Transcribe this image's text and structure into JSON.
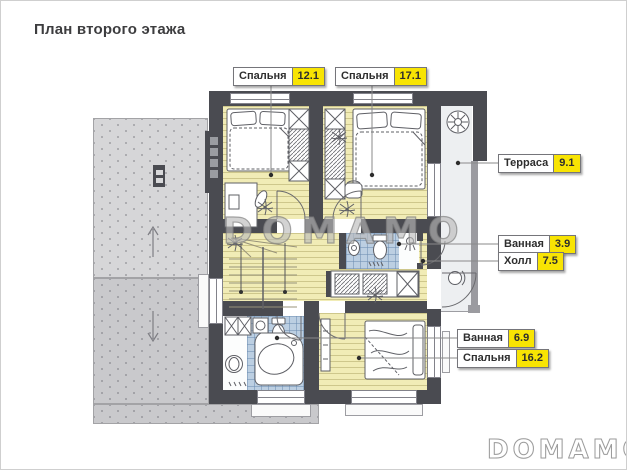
{
  "title": "План второго этажа",
  "watermark_text": "DOMAMO",
  "brand_logo": "DOMAMO",
  "colors": {
    "wall": "#4a4b51",
    "floor_wood": "#f1ecb6",
    "floor_tile": "#bccfe2",
    "roof_light": "#d6d6d8",
    "roof_dark": "#c9c9cc",
    "terrace_floor": "#edeff1",
    "label_highlight": "#f8e403",
    "label_border": "#75757a",
    "title_color": "#3d3d3f"
  },
  "rooms": [
    {
      "id": "bedroom-121",
      "name": "Спальня",
      "area": "12.1"
    },
    {
      "id": "bedroom-171",
      "name": "Спальня",
      "area": "17.1"
    },
    {
      "id": "terrace",
      "name": "Терраса",
      "area": "9.1"
    },
    {
      "id": "bathroom-39",
      "name": "Ванная",
      "area": "3.9"
    },
    {
      "id": "hall",
      "name": "Холл",
      "area": "7.5"
    },
    {
      "id": "bathroom-69",
      "name": "Ванная",
      "area": "6.9"
    },
    {
      "id": "bedroom-162",
      "name": "Спальня",
      "area": "16.2"
    }
  ]
}
